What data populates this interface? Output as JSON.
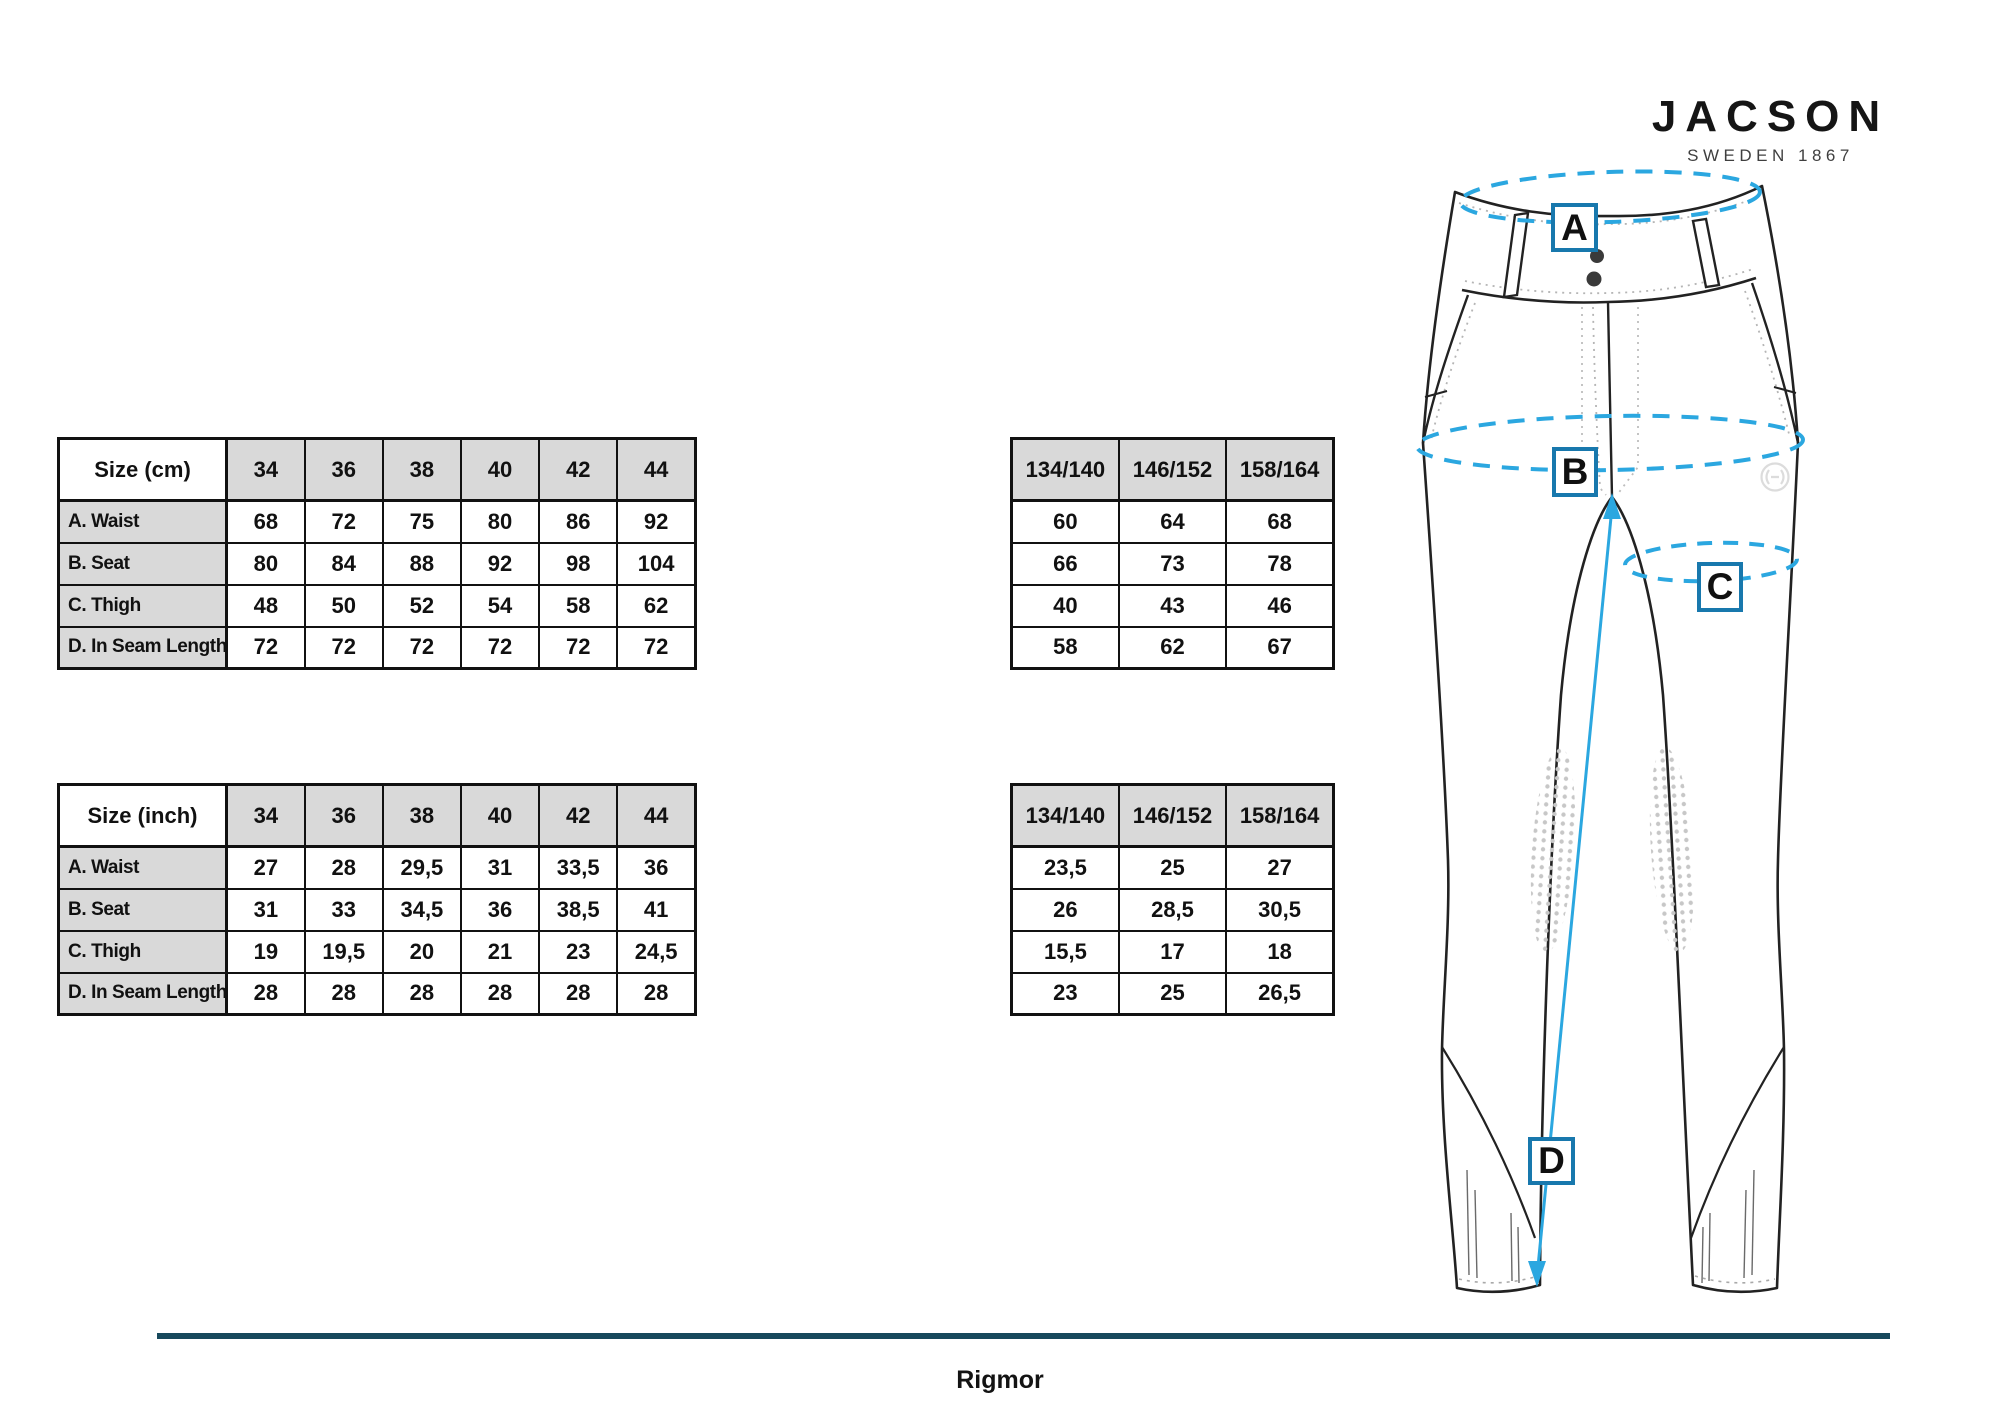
{
  "brand": {
    "name": "JACSON",
    "tagline": "SWEDEN 1867"
  },
  "product_name": "Rigmor",
  "tables": {
    "adult_cm": {
      "title": "Size (cm)",
      "columns": [
        "34",
        "36",
        "38",
        "40",
        "42",
        "44"
      ],
      "rows": [
        {
          "label": "A. Waist",
          "values": [
            "68",
            "72",
            "75",
            "80",
            "86",
            "92"
          ]
        },
        {
          "label": "B. Seat",
          "values": [
            "80",
            "84",
            "88",
            "92",
            "98",
            "104"
          ]
        },
        {
          "label": "C. Thigh",
          "values": [
            "48",
            "50",
            "52",
            "54",
            "58",
            "62"
          ]
        },
        {
          "label": "D. In Seam Length",
          "values": [
            "72",
            "72",
            "72",
            "72",
            "72",
            "72"
          ]
        }
      ]
    },
    "kids_cm": {
      "columns": [
        "134/140",
        "146/152",
        "158/164"
      ],
      "rows": [
        {
          "values": [
            "60",
            "64",
            "68"
          ]
        },
        {
          "values": [
            "66",
            "73",
            "78"
          ]
        },
        {
          "values": [
            "40",
            "43",
            "46"
          ]
        },
        {
          "values": [
            "58",
            "62",
            "67"
          ]
        }
      ]
    },
    "adult_inch": {
      "title": "Size (inch)",
      "columns": [
        "34",
        "36",
        "38",
        "40",
        "42",
        "44"
      ],
      "rows": [
        {
          "label": "A. Waist",
          "values": [
            "27",
            "28",
            "29,5",
            "31",
            "33,5",
            "36"
          ]
        },
        {
          "label": "B. Seat",
          "values": [
            "31",
            "33",
            "34,5",
            "36",
            "38,5",
            "41"
          ]
        },
        {
          "label": "C. Thigh",
          "values": [
            "19",
            "19,5",
            "20",
            "21",
            "23",
            "24,5"
          ]
        },
        {
          "label": "D. In Seam Length",
          "values": [
            "28",
            "28",
            "28",
            "28",
            "28",
            "28"
          ]
        }
      ]
    },
    "kids_inch": {
      "columns": [
        "134/140",
        "146/152",
        "158/164"
      ],
      "rows": [
        {
          "values": [
            "23,5",
            "25",
            "27"
          ]
        },
        {
          "values": [
            "26",
            "28,5",
            "30,5"
          ]
        },
        {
          "values": [
            "15,5",
            "17",
            "18"
          ]
        },
        {
          "values": [
            "23",
            "25",
            "26,5"
          ]
        }
      ]
    }
  },
  "diagram": {
    "markers": {
      "a": "A",
      "b": "B",
      "c": "C",
      "d": "D"
    }
  },
  "colors": {
    "accent_blue": "#2BA7E0",
    "marker_border": "#1878AD",
    "divider_teal": "#17495C",
    "table_header_gray": "#D9D9D9"
  }
}
